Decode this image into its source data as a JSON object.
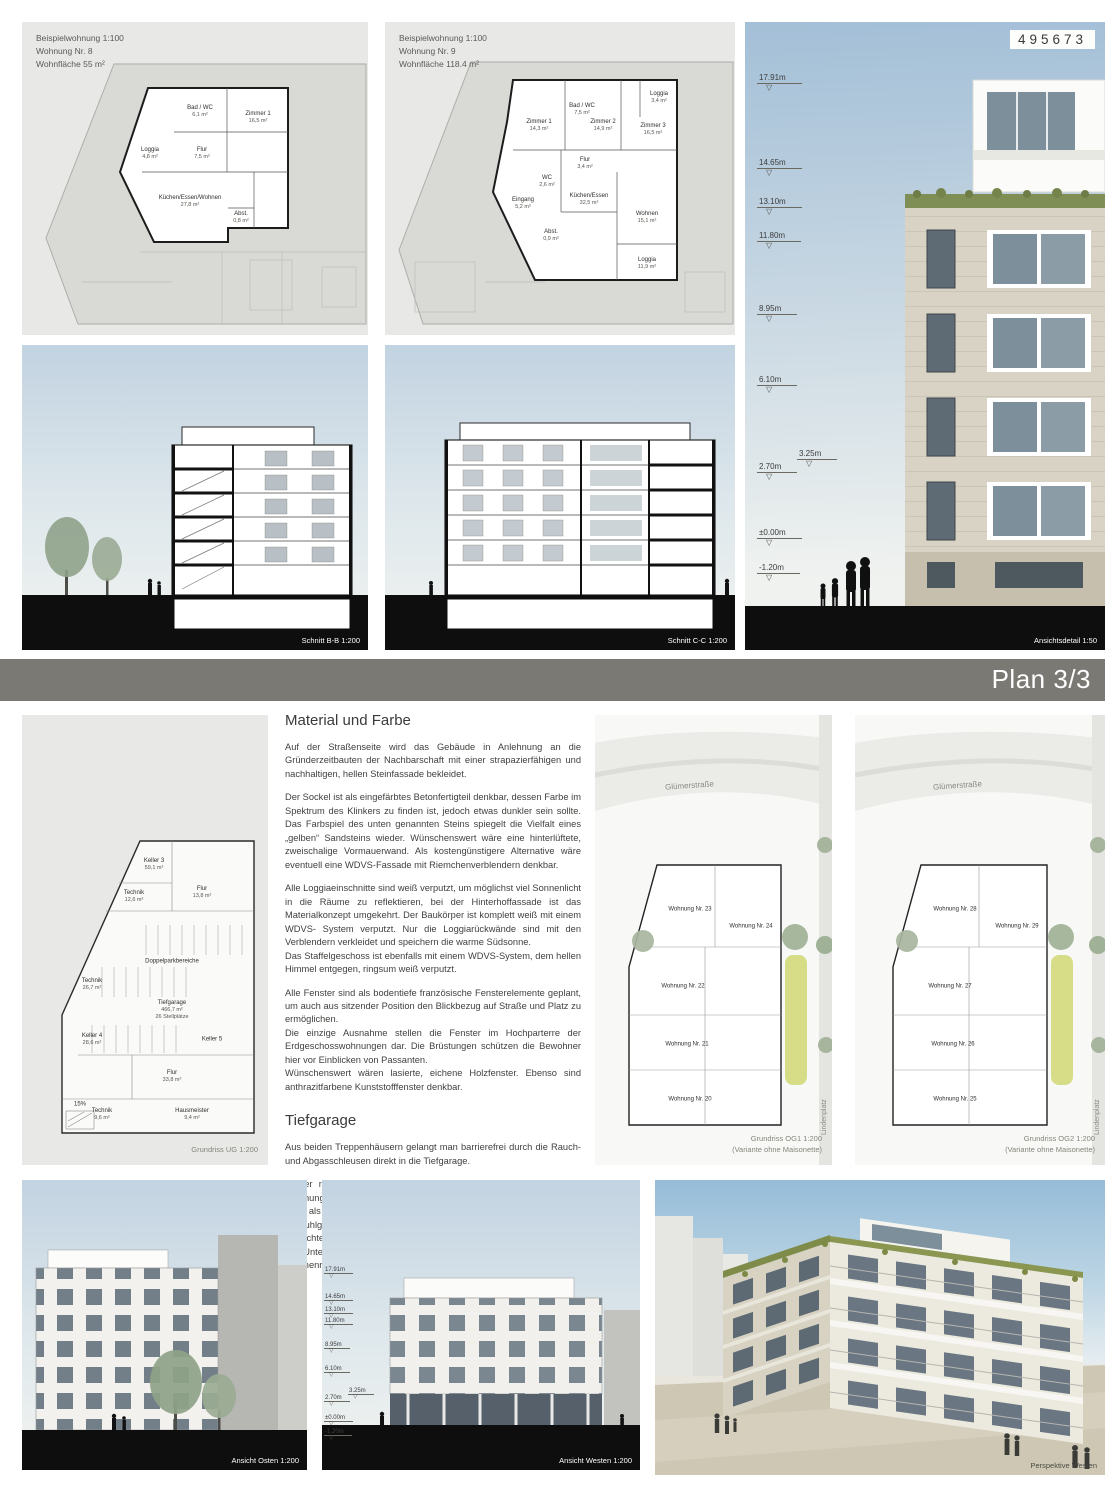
{
  "page": {
    "id_number": "495673"
  },
  "banner": {
    "label": "Plan 3/3"
  },
  "colors": {
    "sky_top": "#a3bfd7",
    "panel_gray": "#e8e8e6",
    "banner_gray": "#7a7973",
    "ground_black": "#0e0e0e",
    "facade_stone": "#d9d3c5",
    "glass": "#7d8f9b",
    "green_roof": "#7f8e55",
    "courtyard_green": "#d6dd86"
  },
  "apartment8": {
    "header_lines": [
      "Beispielwohnung 1:100",
      "Wohnung Nr. 8",
      "Wohnfläche 55 m²"
    ],
    "rooms": [
      {
        "n": "Zimmer 1",
        "a": "16,5 m²"
      },
      {
        "n": "Bad / WC",
        "a": "6,1 m²"
      },
      {
        "n": "Loggia",
        "a": "4,8 m²"
      },
      {
        "n": "Flur",
        "a": "7,5 m²"
      },
      {
        "n": "Küchen/Essen/Wohnen",
        "a": "27,8 m²"
      },
      {
        "n": "Abst.",
        "a": "0,8 m²"
      }
    ]
  },
  "apartment9": {
    "header_lines": [
      "Beispielwohnung 1:100",
      "Wohnung Nr. 9",
      "Wohnfläche 118.4 m²"
    ],
    "rooms": [
      {
        "n": "Loggia",
        "a": "3,4 m²"
      },
      {
        "n": "Bad / WC",
        "a": "7,5 m²"
      },
      {
        "n": "Zimmer 1",
        "a": "14,3 m²"
      },
      {
        "n": "Zimmer 2",
        "a": "14,9 m²"
      },
      {
        "n": "Zimmer 3",
        "a": "16,5 m²"
      },
      {
        "n": "Flur",
        "a": "3,4 m²"
      },
      {
        "n": "WC",
        "a": "2,6 m²"
      },
      {
        "n": "Eingang",
        "a": "5,2 m²"
      },
      {
        "n": "Küchen/Essen",
        "a": "32,5 m²"
      },
      {
        "n": "Abst.",
        "a": "0,9 m²"
      },
      {
        "n": "Wohnen",
        "a": "15,1 m²"
      },
      {
        "n": "Loggia",
        "a": "11,9 m²"
      }
    ]
  },
  "sections": {
    "bb_caption": "Schnitt B-B 1:200",
    "cc_caption": "Schnitt C-C 1:200"
  },
  "detail": {
    "caption": "Ansichtsdetail 1:50",
    "heights": [
      "17.91m",
      "14.65m",
      "13.10m",
      "11.80m",
      "8.95m",
      "6.10m",
      "3.25m",
      "2.70m",
      "±0.00m",
      "-1.20m"
    ]
  },
  "ug": {
    "caption": "Grundriss UG 1:200",
    "garage": {
      "n": "Tiefgarage",
      "a": "466,7 m²",
      "b": "26 Stellplätze"
    },
    "rooms": [
      {
        "n": "Keller 3",
        "a": "59,1 m²"
      },
      {
        "n": "Technik",
        "a": "12,6 m²"
      },
      {
        "n": "Flur",
        "a": "13,8 m²"
      },
      {
        "n": "Doppelparkbereiche",
        "a": ""
      },
      {
        "n": "Technik",
        "a": "26,7 m²"
      },
      {
        "n": "Keller 4",
        "a": "28,6 m²"
      },
      {
        "n": "Keller 5",
        "a": ""
      },
      {
        "n": "Flur",
        "a": "33,8 m²"
      },
      {
        "n": "Technik",
        "a": "9,6 m²"
      },
      {
        "n": "Hausmeister",
        "a": "9,4 m²"
      }
    ],
    "ramp_label": "15%"
  },
  "texts": {
    "material": {
      "heading": "Material und Farbe",
      "paras": [
        "Auf der Straßenseite wird das Gebäude in Anlehnung an die Gründerzeitbauten der Nachbarschaft mit einer strapazierfähigen und nachhaltigen, hellen Steinfassade bekleidet.",
        "Der Sockel ist als eingefärbtes Betonfertigteil denkbar, dessen Farbe im Spektrum des Klinkers zu finden ist, jedoch etwas dunkler sein sollte. Das Farbspiel des unten genannten Steins spiegelt die Vielfalt eines „gelben“ Sandsteins wieder. Wünschenswert wäre eine hinterlüftete, zweischalige Vormauerwand. Als kostengünstigere Alternative wäre eventuell eine WDVS-Fassade mit Riemchenverblendern denkbar.",
        "Alle Loggiaeinschnitte sind weiß verputzt, um möglichst viel Sonnenlicht in die Räume zu reflektieren, bei der Hinterhoffassade ist das Materialkonzept umgekehrt. Der Baukörper ist komplett weiß mit einem WDVS- System verputzt. Nur die Loggiarückwände sind mit den Verblendern verkleidet und speichern die warme Südsonne.\nDas Staffelgeschoss ist ebenfalls mit einem WDVS-System, dem hellen Himmel entgegen, ringsum weiß verputzt.",
        "Alle Fenster sind als bodentiefe französische Fensterelemente geplant, um auch aus sitzender Position den Blickbezug auf Straße und Platz zu ermöglichen.\nDie einzige Ausnahme stellen die Fenster im Hochparterre der Erdgeschosswohnungen dar.  Die Brüstungen schützen die Bewohner hier vor Einblicken von Passanten.\nWünschenswert wären lasierte, eichene Holzfenster. Ebenso sind anthrazitfarbene Kunststofffenster denkbar."
      ]
    },
    "tiefgarage": {
      "heading": "Tiefgarage",
      "paras": [
        "Aus beiden Treppenhäusern gelangt man barrierefrei durch die Rauch- und Abgasschleusen direkt in die Tiefgarage.",
        "In der natürlich belüfteten und belichteten Tiefgarage ist für jede Wohnung ein Stellplatz untergebracht  (gesamt 26 Stück). Zwölf davon sind als Doppelparker konzipiert. Zwei der Normalstellplätze sind rollstuhlgerecht.\nDie lichte Höhe der Tiefgarage beträgt mindestens 2,20 m, im Bereich der Unterzüge 2,00 m. Die überdachte Rampe ist mit Kuppen- und Wannenradius ausgebildet und hat maximal 15 % Steigung."
      ]
    }
  },
  "og1": {
    "street": "Glümerstraße",
    "platz": "Lindenplatz",
    "caption_lines": [
      "Grundriss OG1 1:200",
      "(Variante ohne Maisonette)"
    ],
    "units": [
      "Wohnung Nr. 20",
      "Wohnung Nr. 21",
      "Wohnung Nr. 22",
      "Wohnung Nr. 23",
      "Wohnung Nr. 24"
    ]
  },
  "og2": {
    "street": "Glümerstraße",
    "platz": "Lindenplatz",
    "caption_lines": [
      "Grundriss OG2 1:200",
      "(Variante ohne Maisonette)"
    ],
    "units": [
      "Wohnung Nr. 25",
      "Wohnung Nr. 26",
      "Wohnung Nr. 27",
      "Wohnung Nr. 28",
      "Wohnung Nr. 29"
    ]
  },
  "elevation_east": {
    "caption": "Ansicht Osten 1:200"
  },
  "elevation_west": {
    "caption": "Ansicht Westen 1:200"
  },
  "perspective": {
    "caption": "Perspektive Westen"
  }
}
